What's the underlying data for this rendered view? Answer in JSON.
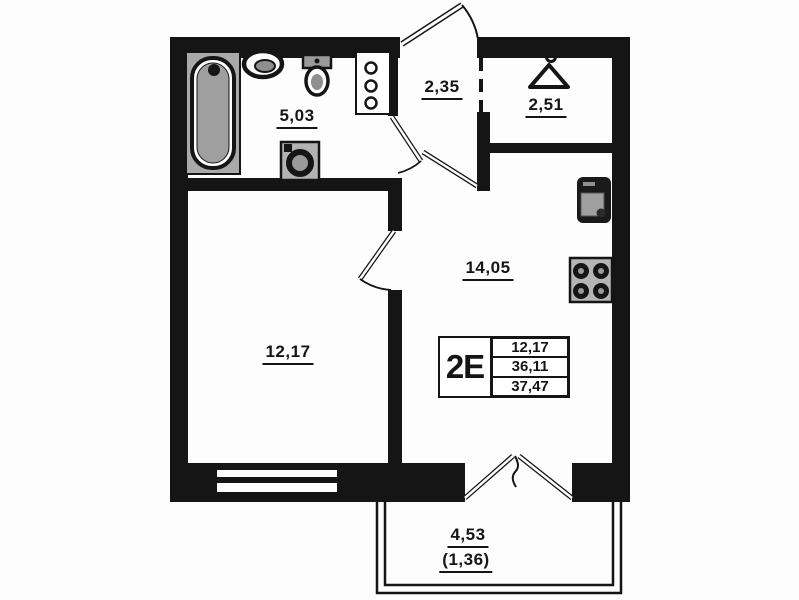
{
  "unit_card": {
    "code": "2E",
    "values": [
      "12,17",
      "36,11",
      "37,47"
    ]
  },
  "rooms": {
    "bathroom": {
      "area": "5,03"
    },
    "hallway": {
      "area": "2,35"
    },
    "wardrobe": {
      "area": "2,51"
    },
    "kitchen_living": {
      "area": "14,05"
    },
    "room": {
      "area": "12,17"
    },
    "balcony": {
      "area": "4,53",
      "area_with_factor": "(1,36)"
    }
  },
  "icons": [
    "bathtub-icon",
    "wash-basin-icon",
    "toilet-icon",
    "washing-machine-icon",
    "plumbing-riser-icon",
    "hanger-icon",
    "kitchen-sink-icon",
    "stove-icon"
  ],
  "colors": {
    "wall": "#151515",
    "fixture_gray": "#a9a9a9",
    "background": "#ffffff"
  }
}
